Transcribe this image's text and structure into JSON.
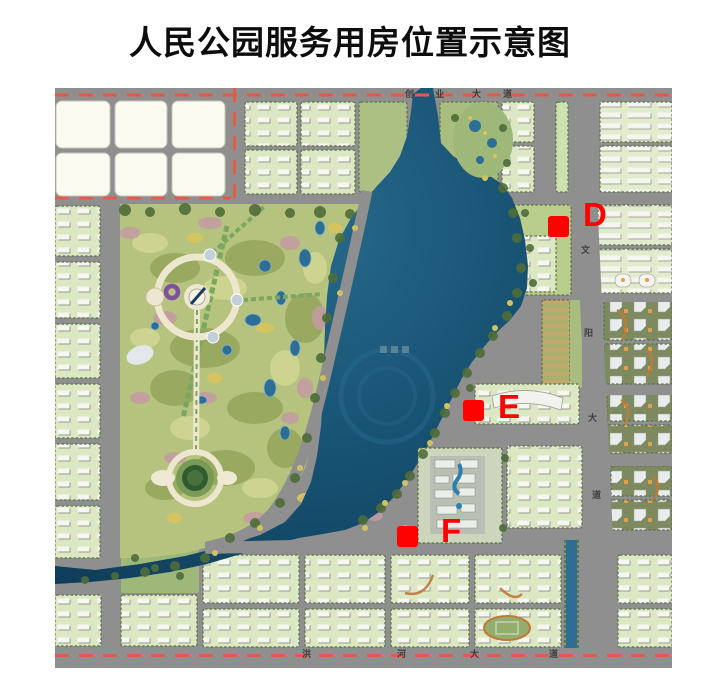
{
  "title": "人民公园服务用房位置示意图",
  "map": {
    "markers": [
      {
        "id": "D",
        "label": "D"
      },
      {
        "id": "E",
        "label": "E"
      },
      {
        "id": "F",
        "label": "F"
      }
    ],
    "roads": {
      "top": {
        "name": "创业大道",
        "chars": [
          "创",
          "业",
          "大",
          "道"
        ]
      },
      "bottom": {
        "name": "洪河大道",
        "chars": [
          "洪",
          "河",
          "大",
          "道"
        ]
      },
      "right": {
        "name": "文阳大道",
        "chars": [
          "文",
          "阳",
          "大",
          "道"
        ]
      }
    },
    "colors": {
      "marker_red": "#fe0101",
      "road_dash_red": "#e25b4a",
      "lake_blue": "#175172",
      "park_green": "#b5c37e",
      "block_green": "#dce7c3",
      "road_gray": "#8f8f8f",
      "empty_block_cream": "#fbfaf0"
    }
  }
}
